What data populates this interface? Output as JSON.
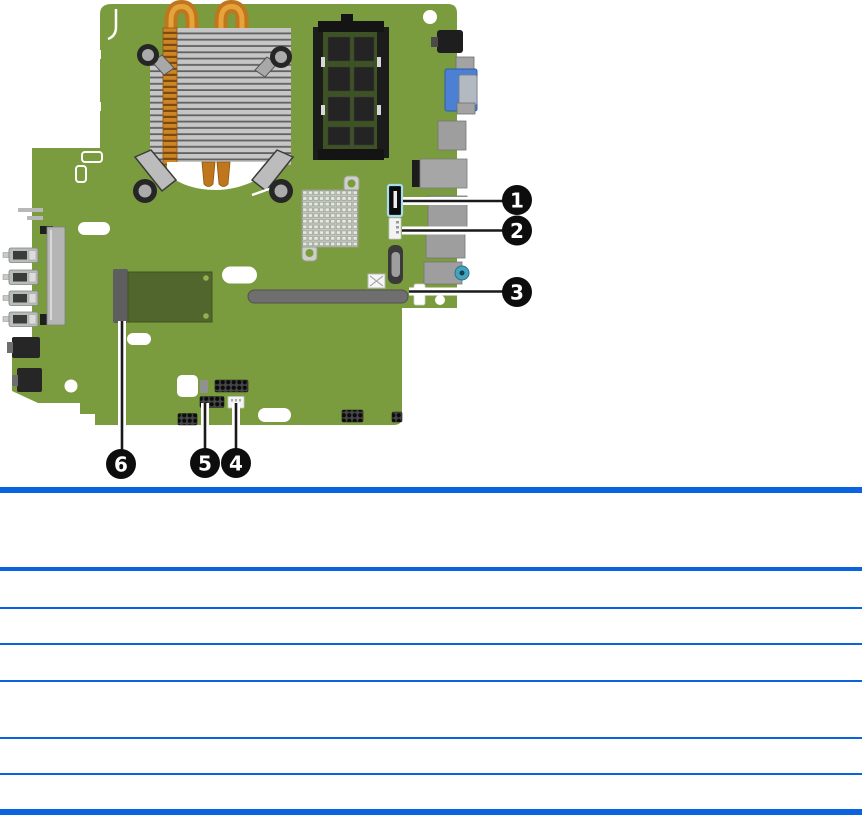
{
  "figure": {
    "kind": "system-board-callout-diagram",
    "callouts": [
      {
        "label": "1",
        "target": "sata-connector"
      },
      {
        "label": "2",
        "target": "small-white-connector"
      },
      {
        "label": "3",
        "target": "expansion-slot"
      },
      {
        "label": "4",
        "target": "white-header-connector"
      },
      {
        "label": "5",
        "target": "pin-header"
      },
      {
        "label": "6",
        "target": "mini-card-module"
      }
    ]
  },
  "table": {
    "header_text": "",
    "rows": [
      "",
      "",
      "",
      "",
      "",
      ""
    ]
  },
  "colors": {
    "table_rule_blue": "#0a64e0",
    "board_green": "#7a9c3e",
    "module_green": "#50662c",
    "ram_pcb_green": "#3e5324",
    "heatsink_silver": "#c6c6c6",
    "copper_orange": "#c0761c",
    "vga_blue": "#4b80d2",
    "sata_outline_cyan": "#a8dcec",
    "audio_jack_teal": "#44a3bd",
    "callout_black": "#0d0d0d"
  }
}
